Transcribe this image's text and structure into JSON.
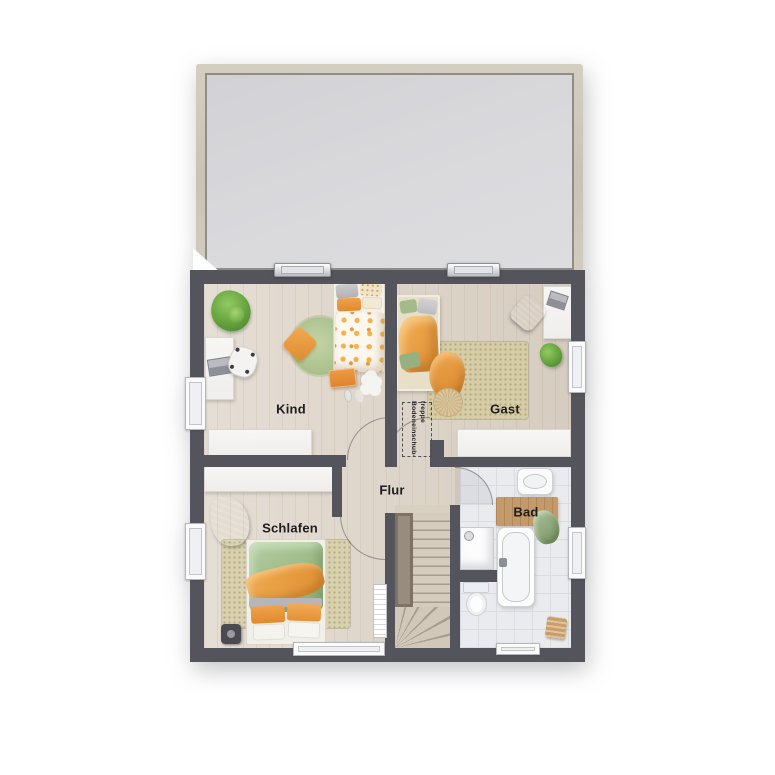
{
  "floorplan": {
    "title": "Obergeschoss Grundriss",
    "rooms": [
      {
        "id": "kind",
        "label": "Kind"
      },
      {
        "id": "gast",
        "label": "Gast"
      },
      {
        "id": "flur",
        "label": "Flur"
      },
      {
        "id": "schlafen",
        "label": "Schlafen"
      },
      {
        "id": "bad",
        "label": "Bad"
      }
    ],
    "annotations": {
      "attic_ladder_line1": "Bodeneinschub-",
      "attic_ladder_line2": "treppe"
    },
    "colors": {
      "wall": "#54555c",
      "wood_floor": "#ddd3c6",
      "tile_floor": "#eaebee",
      "roof_area": "#d7d7db",
      "roof_frame": "#cac3b5",
      "rug_beige": "#d6cca5",
      "rug_green": "#aec28f",
      "accent_orange": "#e8953f",
      "bedding_green": "#a8c599",
      "stair_wood": "#d6ccbe",
      "bath_mat_wood": "#c49a6a"
    }
  }
}
